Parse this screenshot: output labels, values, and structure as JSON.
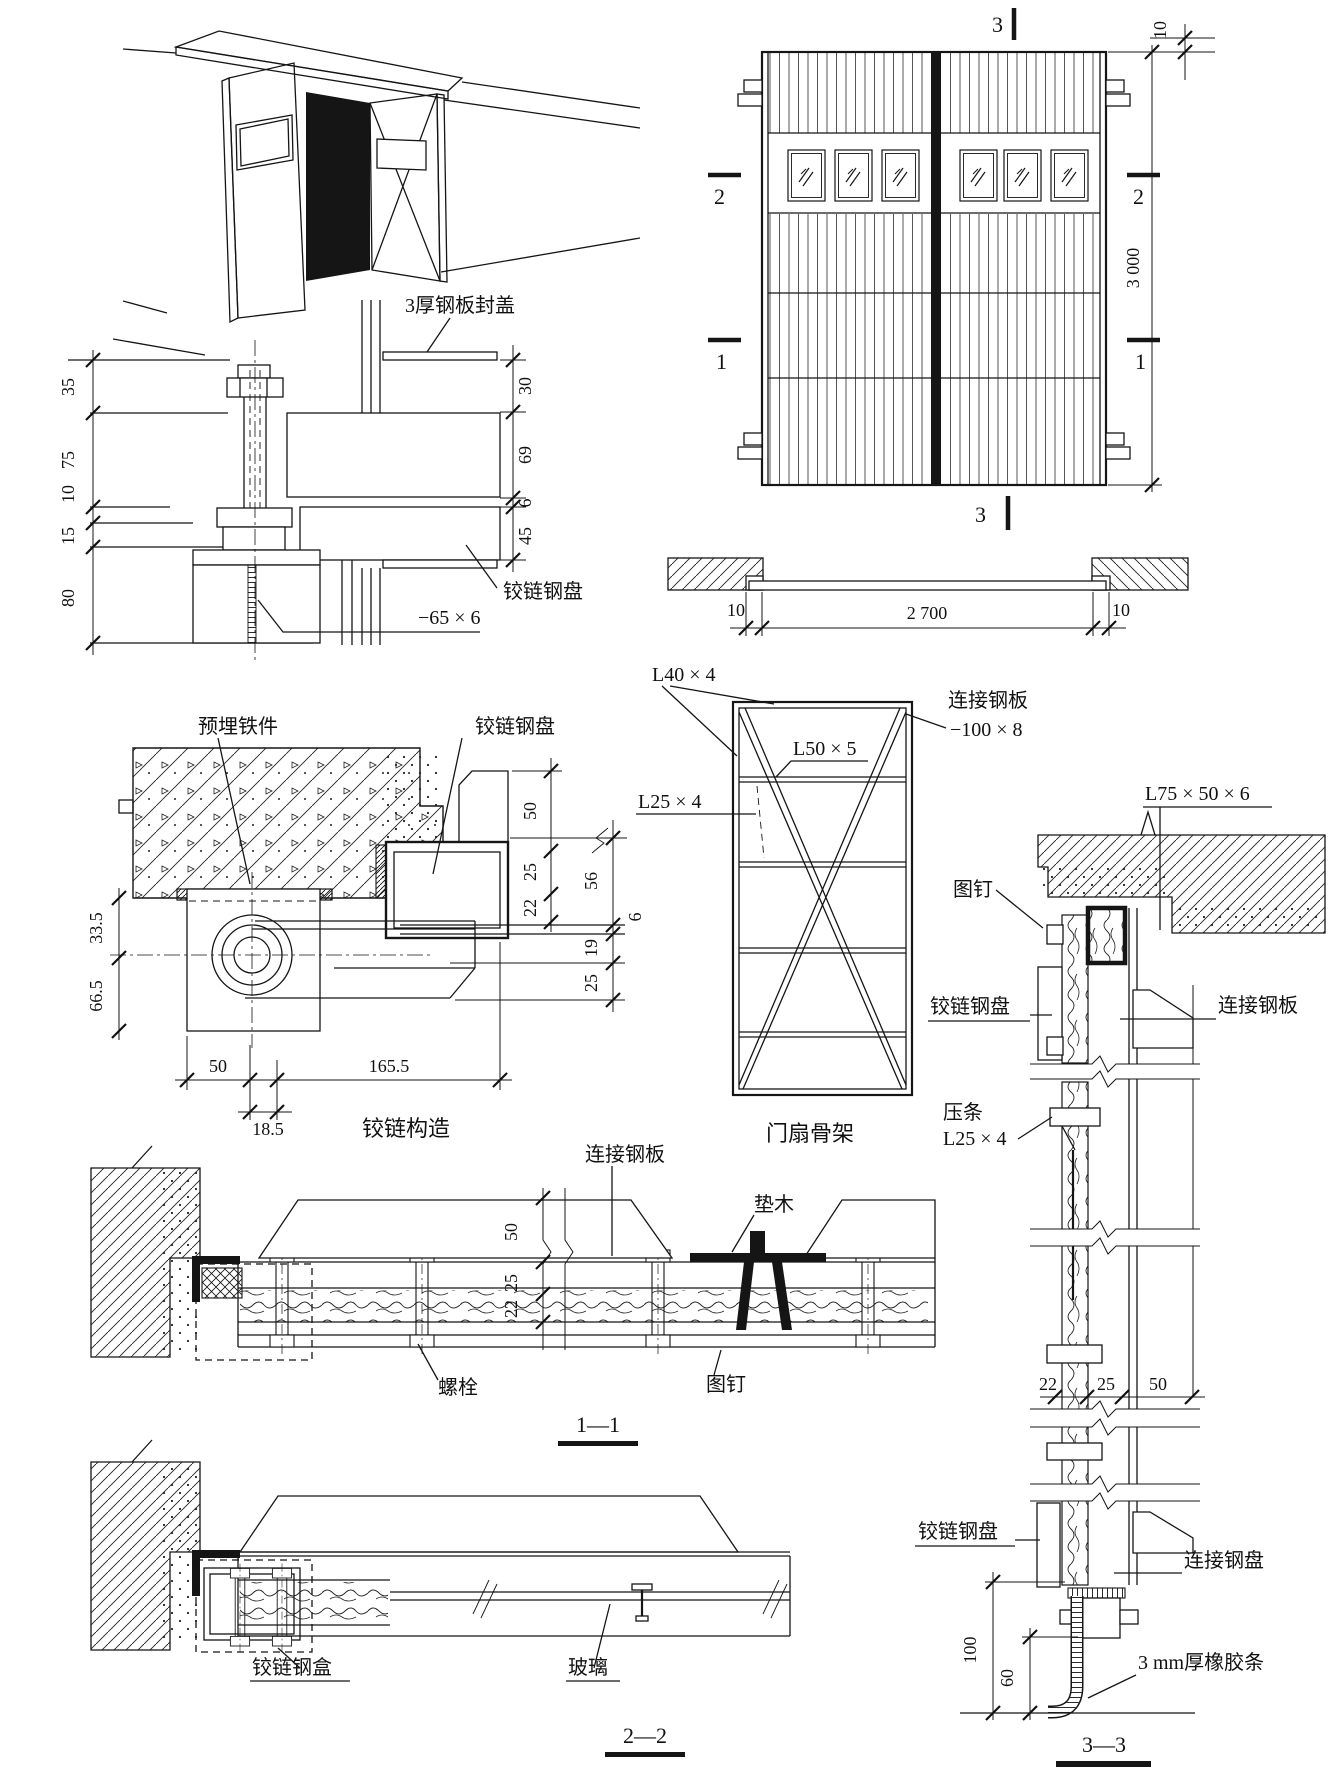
{
  "drawing": {
    "elevation": {
      "marker_top": "3",
      "marker_bottom": "3",
      "marker_sec2": "2",
      "marker_sec1": "1",
      "dim_top_gap": "10",
      "dim_height": "3 000"
    },
    "plan": {
      "dim_left": "10",
      "dim_opening": "2 700",
      "dim_right": "10"
    },
    "pivot_detail": {
      "label_cover": "3厚钢板封盖",
      "label_hinge_plate": "铰链钢盘",
      "label_bar": "−65 × 6",
      "dims_left": [
        "35",
        "75",
        "10",
        "15",
        "80"
      ],
      "dims_right": [
        "30",
        "69",
        "6",
        "45"
      ]
    },
    "hinge_detail": {
      "label_embed": "预埋铁件",
      "label_hinge_plate": "铰链钢盘",
      "dims_inner": [
        "50",
        "25",
        "22"
      ],
      "dims_outer": [
        "56",
        "6",
        "19",
        "25"
      ],
      "dims_left": [
        "33.5",
        "66.5"
      ],
      "dims_bottom": [
        "50",
        "165.5",
        "18.5"
      ],
      "caption": "铰链构造"
    },
    "skeleton": {
      "label_l40": "L40 × 4",
      "label_plate": "连接钢板",
      "label_plate_size": "−100 × 8",
      "label_l50": "L50 × 5",
      "label_l25": "L25 × 4",
      "caption": "门扇骨架"
    },
    "section11": {
      "label_plate": "连接钢板",
      "label_block": "垫木",
      "dims": [
        "50",
        "25",
        "22"
      ],
      "label_bolt": "螺栓",
      "label_tack": "图钉",
      "caption": "1—1"
    },
    "section22": {
      "label_hinge_box": "铰链钢盒",
      "label_glass": "玻璃",
      "caption": "2—2"
    },
    "section33": {
      "label_angle": "L75 × 50 × 6",
      "label_tack": "图钉",
      "label_hinge_plate_top": "铰链钢盘",
      "label_plate_top": "连接钢板",
      "label_bead1": "压条",
      "label_bead2": "L25 × 4",
      "dims_mid": [
        "22",
        "25",
        "50"
      ],
      "label_hinge_plate_bottom": "铰链钢盘",
      "label_plate_bottom": "连接钢盘",
      "dim_100": "100",
      "dim_60": "60",
      "label_rubber": "3 mm厚橡胶条",
      "caption": "3—3"
    }
  }
}
